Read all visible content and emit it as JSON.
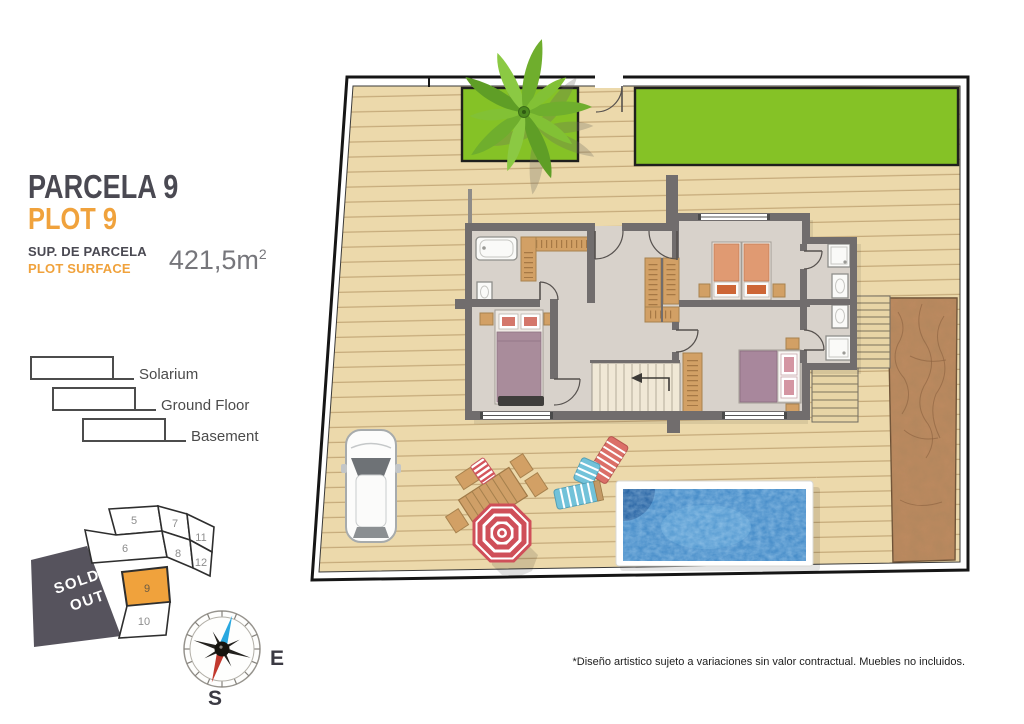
{
  "header": {
    "title_es": "PARCELA 9",
    "title_en": "PLOT 9",
    "surface_label_es": "SUP. DE PARCELA",
    "surface_label_en": "PLOT SURFACE",
    "surface_value_base": "421,5m",
    "surface_exponent": "2"
  },
  "legend": {
    "items": [
      {
        "label": "Solarium"
      },
      {
        "label": "Ground Floor"
      },
      {
        "label": "Basement"
      }
    ]
  },
  "minimap": {
    "sold_out_line1": "SOLD",
    "sold_out_line2": "OUT",
    "highlighted_plot": "9",
    "plots": [
      {
        "number": "5"
      },
      {
        "number": "7"
      },
      {
        "number": "11"
      },
      {
        "number": "6"
      },
      {
        "number": "8"
      },
      {
        "number": "12"
      },
      {
        "number": "9"
      },
      {
        "number": "10"
      }
    ]
  },
  "compass": {
    "east_label": "E",
    "south_label": "S"
  },
  "footer": {
    "disclaimer": "*Diseño artistico sujeto a variaciones sin valor contractual. Muebles no incluidos."
  },
  "colors": {
    "accent_orange": "#f0a23c",
    "title_gray": "#4a4952",
    "deck": "#ecd9ab",
    "grass": "#85c226",
    "pool_water": "#3d86c5",
    "pool_shadow": "#1e5c9e",
    "dirt": "#bd8a60",
    "wall": "#716d6d",
    "floor": "#d8d2cb",
    "sold_out_bg": "#56535d",
    "wood": "#d2a065",
    "bed_mauve": "#a98c9b",
    "bed_salmon": "#e09a72",
    "umbrella_red": "#cf4f59",
    "lounger_blue": "#72c2d9"
  }
}
